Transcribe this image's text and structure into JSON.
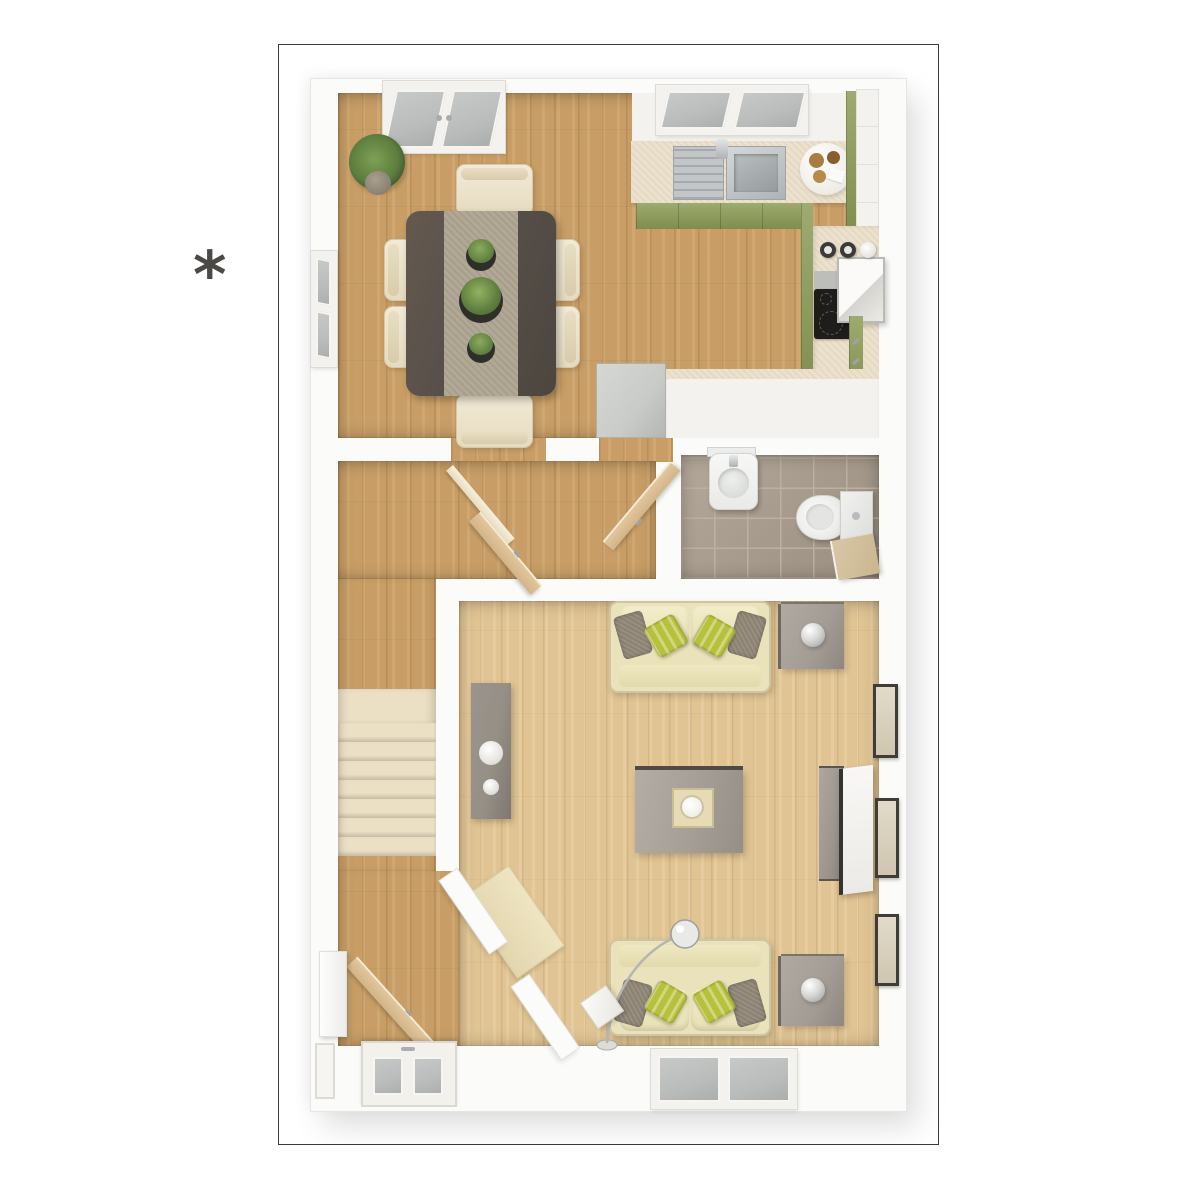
{
  "annotation": {
    "symbol": "*"
  },
  "plan": {
    "type": "floor-plan-3d-top-view",
    "floor_shown": "ground-floor",
    "palette": {
      "ink": "#4b4945",
      "frame-line": "#3b3936",
      "wall": "#fbfbf9",
      "wood-mid": "#c89e66",
      "wood-pale": "#e0c493",
      "wood-door": "#e2c69c",
      "carpet": "#ebdfc4",
      "tile": "#a79a8a",
      "tile-line": "#bcb1a1",
      "counter": "#ebe1cd",
      "olive": "#8e9d57",
      "steel": "#c2c6c9",
      "glass": "#b9bcba",
      "white-ish": "#f4f2ee",
      "sofa": "#eae2ba",
      "pillow": "#b8c13c",
      "cushion": "#8c8272",
      "table-dark": "#57504a",
      "runner": "#b2a896",
      "grey-table": "#a39c94",
      "grey-appliance": "#c9cbc8",
      "grey-mid": "#968f86",
      "frame-dark": "#403c37",
      "plant": "#5d7d3e",
      "plant-dark": "#39472a",
      "hob-black": "#1e1d1b",
      "silver": "#b5b5b3",
      "beige-door": "#d8c8a6"
    },
    "rooms": [
      {
        "id": "kitchen-dining",
        "floor": "oak"
      },
      {
        "id": "hallway",
        "floor": "oak"
      },
      {
        "id": "wc",
        "floor": "taupe-tile"
      },
      {
        "id": "living-room",
        "floor": "pale-oak"
      },
      {
        "id": "stairs",
        "floor": "cream-carpet"
      },
      {
        "id": "entrance-hall",
        "floor": "oak"
      }
    ],
    "furniture": [
      "dining-table",
      "table-runner",
      "potted-plants-x3",
      "dining-chairs-x6",
      "corner-plant",
      "french-doors",
      "kitchen-window",
      "dining-window",
      "kitchen-sink",
      "kitchen-tap",
      "serving-tray",
      "green-cabinets",
      "tall-cabinet",
      "canisters-x3",
      "hob",
      "extractor-oven",
      "peninsula-counter",
      "appliance",
      "wash-basin",
      "toilet",
      "toilet-roll-holder",
      "wc-door",
      "hall-doors-x2",
      "stairs-flight",
      "console-table",
      "decor-plates-x2",
      "sofa-x2",
      "scatter-pillows-x4",
      "side-table-x2",
      "table-lamp-x2",
      "coffee-table",
      "tray-with-bowl",
      "tv-unit",
      "tv",
      "picture-frames-x3",
      "arc-floor-lamp",
      "cube-side-table",
      "hall-desk",
      "open-door",
      "front-door",
      "entrance-shelf",
      "living-room-window"
    ]
  }
}
